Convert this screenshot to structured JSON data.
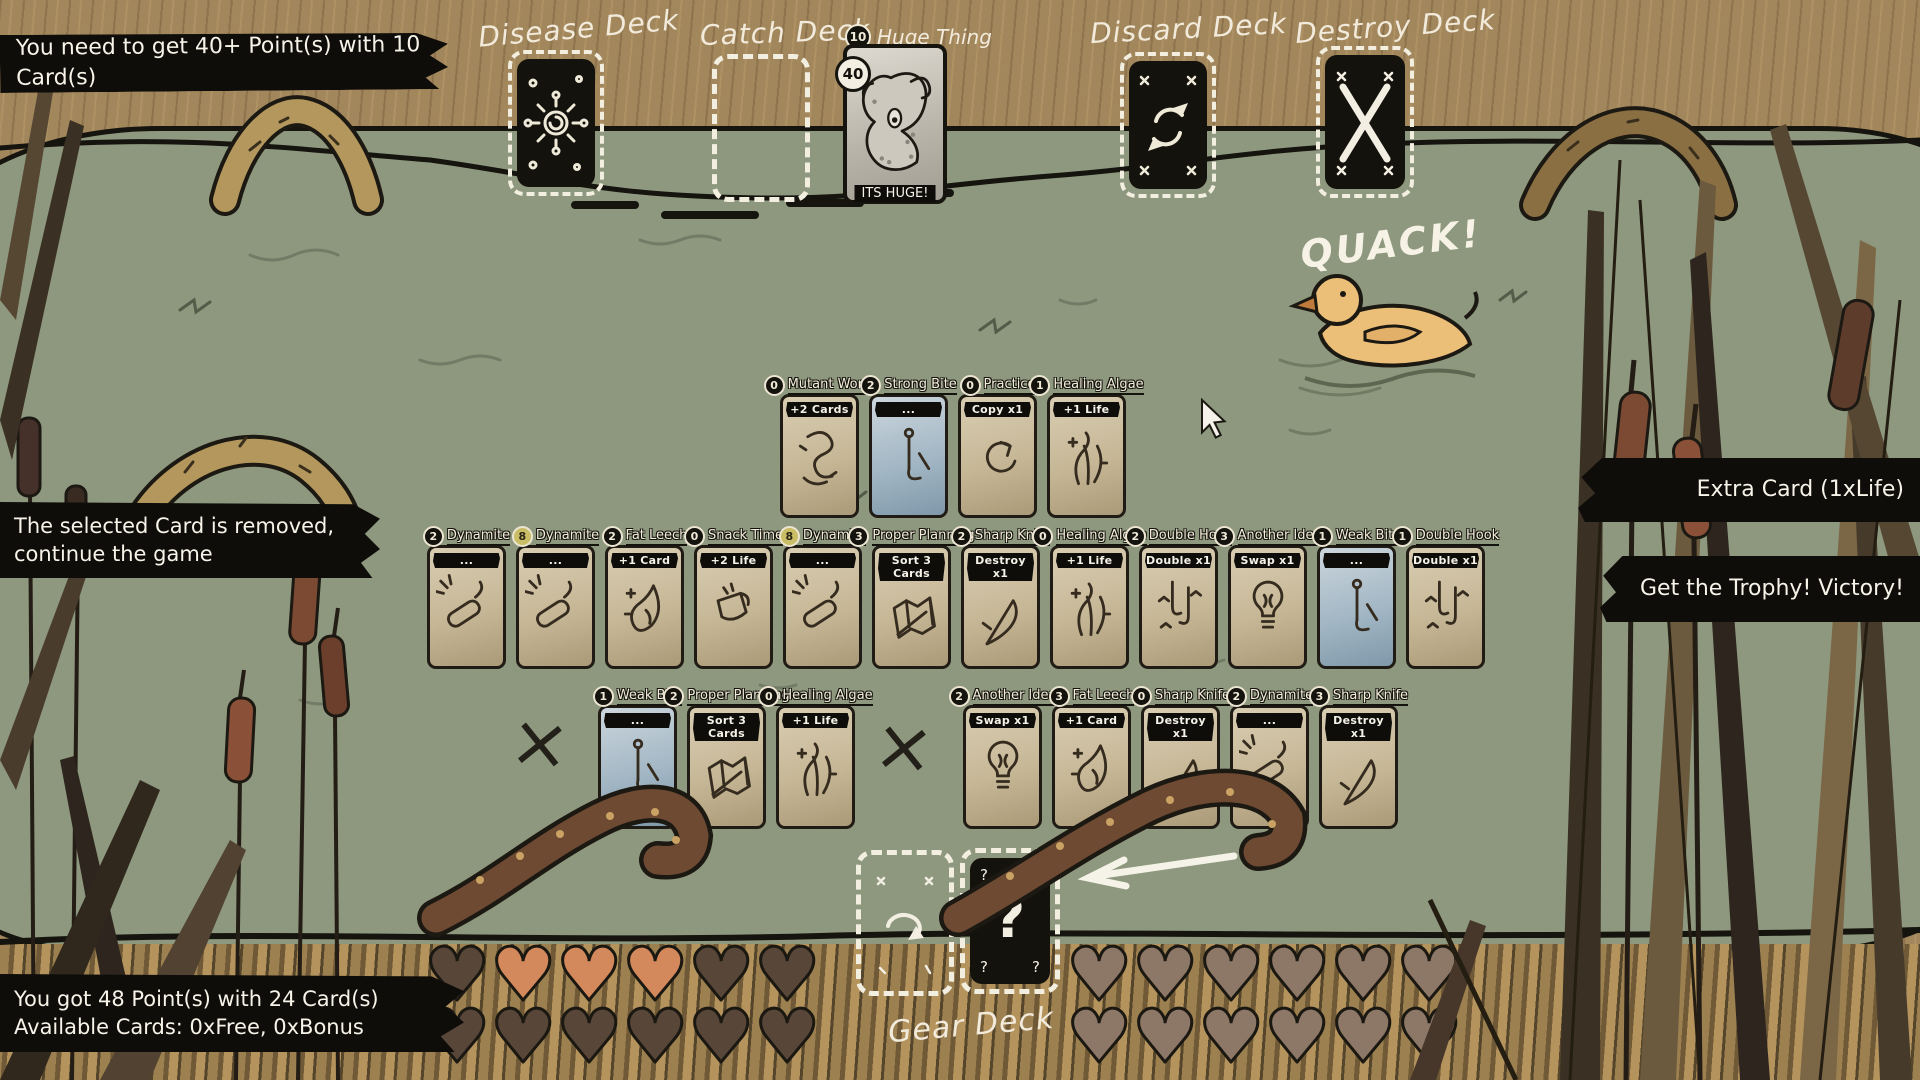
{
  "banners": {
    "goal": "You need to get 40+ Point(s) with 10 Card(s)",
    "removed_line1": "The selected Card is removed,",
    "removed_line2": "continue the game",
    "extra_card": "Extra Card (1xLife)",
    "victory": "Get the Trophy! Victory!",
    "score": "You got 48 Point(s) with 24 Card(s)",
    "available": "Available Cards: 0xFree, 0xBonus"
  },
  "deck_labels": {
    "disease": "Disease Deck",
    "catch": "Catch Deck",
    "discard": "Discard Deck",
    "destroy": "Destroy Deck",
    "gear": "Gear Deck"
  },
  "huge_thing": {
    "cost": "10",
    "name": "Huge Thing",
    "points": "40",
    "caption": "ITS HUGE!"
  },
  "quack_text": "QUACK!",
  "misc": {
    "x_mark": "×",
    "gear_symbol": "?",
    "gear_corner": "?"
  },
  "cards": {
    "hand": [
      {
        "value": "0",
        "name": "Mutant Worm",
        "effect": "+2 Cards",
        "variant": "tan",
        "art": "worm",
        "badge": "dark"
      },
      {
        "value": "2",
        "name": "Strong Bite",
        "effect": "...",
        "variant": "blue",
        "art": "hook",
        "badge": "dark"
      },
      {
        "value": "0",
        "name": "Practice",
        "effect": "Copy x1",
        "variant": "tan",
        "art": "copy",
        "badge": "dark"
      },
      {
        "value": "1",
        "name": "Healing Algae",
        "effect": "+1 Life",
        "variant": "tan",
        "art": "algae",
        "badge": "dark"
      }
    ],
    "river": [
      {
        "value": "2",
        "name": "Dynamite",
        "effect": "...",
        "variant": "tan",
        "art": "dynamite",
        "badge": "dark"
      },
      {
        "value": "8",
        "name": "Dynamite",
        "effect": "...",
        "variant": "tan",
        "art": "dynamite",
        "badge": "gold"
      },
      {
        "value": "2",
        "name": "Fat Leech",
        "effect": "+1 Card",
        "variant": "tan",
        "art": "leech",
        "badge": "dark"
      },
      {
        "value": "0",
        "name": "Snack Time",
        "effect": "+2 Life",
        "variant": "tan",
        "art": "snack",
        "badge": "dark"
      },
      {
        "value": "8",
        "name": "Dynamite",
        "effect": "...",
        "variant": "tan",
        "art": "dynamite",
        "badge": "gold"
      },
      {
        "value": "3",
        "name": "Proper Planning",
        "effect": "Sort 3 Cards",
        "variant": "tan",
        "art": "map",
        "badge": "dark"
      },
      {
        "value": "2",
        "name": "Sharp Knife",
        "effect": "Destroy x1",
        "variant": "tan",
        "art": "knife",
        "badge": "dark"
      },
      {
        "value": "0",
        "name": "Healing Algae",
        "effect": "+1 Life",
        "variant": "tan",
        "art": "algae",
        "badge": "dark"
      },
      {
        "value": "2",
        "name": "Double Hook",
        "effect": "Double x1",
        "variant": "tan",
        "art": "doublehook",
        "badge": "dark"
      },
      {
        "value": "3",
        "name": "Another Idea",
        "effect": "Swap x1",
        "variant": "tan",
        "art": "bulb",
        "badge": "dark"
      },
      {
        "value": "1",
        "name": "Weak Bite",
        "effect": "...",
        "variant": "blue",
        "art": "hook",
        "badge": "dark"
      },
      {
        "value": "1",
        "name": "Double Hook",
        "effect": "Double x1",
        "variant": "tan",
        "art": "doublehook",
        "badge": "dark"
      }
    ],
    "bottom_left": [
      {
        "value": "1",
        "name": "Weak Bite",
        "effect": "...",
        "variant": "blue",
        "art": "hook",
        "badge": "dark"
      },
      {
        "value": "2",
        "name": "Proper Planning",
        "effect": "Sort 3 Cards",
        "variant": "tan",
        "art": "map",
        "badge": "dark"
      },
      {
        "value": "0",
        "name": "Healing Algae",
        "effect": "+1 Life",
        "variant": "tan",
        "art": "algae",
        "badge": "dark"
      }
    ],
    "bottom_right": [
      {
        "value": "2",
        "name": "Another Idea",
        "effect": "Swap x1",
        "variant": "tan",
        "art": "bulb",
        "badge": "dark"
      },
      {
        "value": "3",
        "name": "Fat Leech",
        "effect": "+1 Card",
        "variant": "tan",
        "art": "leech",
        "badge": "dark"
      },
      {
        "value": "0",
        "name": "Sharp Knife",
        "effect": "Destroy x1",
        "variant": "tan",
        "art": "knife",
        "badge": "dark"
      },
      {
        "value": "2",
        "name": "Dynamite",
        "effect": "...",
        "variant": "tan",
        "art": "dynamite",
        "badge": "dark"
      },
      {
        "value": "3",
        "name": "Sharp Knife",
        "effect": "Destroy x1",
        "variant": "tan",
        "art": "knife",
        "badge": "dark"
      }
    ]
  },
  "hearts": {
    "left_rows": [
      [
        "dark",
        "orange",
        "orange",
        "orange",
        "dark",
        "dark"
      ],
      [
        "dark",
        "dark",
        "dark",
        "dark",
        "dark",
        "dark"
      ]
    ],
    "right_rows": [
      [
        "light",
        "light",
        "light",
        "light",
        "light",
        "light"
      ],
      [
        "light",
        "light",
        "light",
        "light",
        "light",
        "light"
      ]
    ],
    "colors": {
      "orange": "#d4895c",
      "dark": "#584639",
      "light": "#8d7767"
    }
  },
  "colors": {
    "banner_bg": "#0e0d0a",
    "banner_text": "#f5f2e8",
    "pond": "#8e987e",
    "grass": "#a3875c",
    "card_tan": "#cdc0a3",
    "card_blue": "#a9bcc9",
    "ink": "#1c1913"
  }
}
